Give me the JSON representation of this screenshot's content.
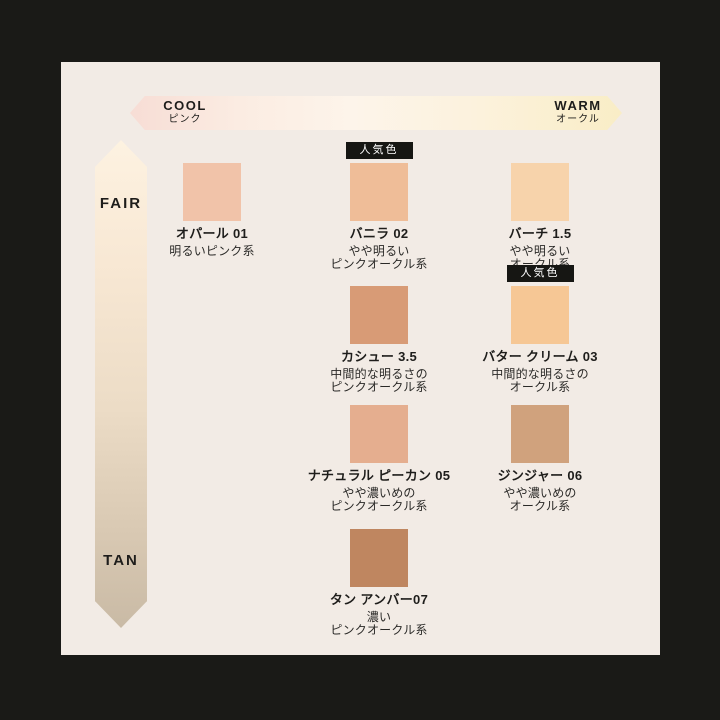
{
  "chart_title": "foundation-shade-map",
  "axes": {
    "horizontal": {
      "cool_label": "COOL",
      "cool_sub": "ピンク",
      "warm_label": "WARM",
      "warm_sub": "オークル",
      "gradient_left": "#f7ddd5",
      "gradient_right": "#f9edc6"
    },
    "vertical": {
      "top_label": "FAIR",
      "bottom_label": "TAN",
      "gradient_top": "#fdf2e1",
      "gradient_bottom": "#c9baa5"
    }
  },
  "badge_label": "人気色",
  "palette": {
    "frame": "#1a1a17",
    "panel_background": "#f2ebe5",
    "badge_background": "#161613",
    "badge_text": "#ffffff",
    "text": "#1e1d1b"
  },
  "shades": [
    {
      "name": "オパール 01",
      "desc1": "明るいピンク系",
      "desc2": "",
      "color": "#f1c3a9",
      "popular": false
    },
    {
      "name": "バニラ 02",
      "desc1": "やや明るい",
      "desc2": "ピンクオークル系",
      "color": "#efbd98",
      "popular": true
    },
    {
      "name": "バーチ 1.5",
      "desc1": "やや明るい",
      "desc2": "オークル系",
      "color": "#f7d3ab",
      "popular": false
    },
    {
      "name": "カシュー 3.5",
      "desc1": "中間的な明るさの",
      "desc2": "ピンクオークル系",
      "color": "#d89b76",
      "popular": false
    },
    {
      "name": "バター クリーム 03",
      "desc1": "中間的な明るさの",
      "desc2": "オークル系",
      "color": "#f6c795",
      "popular": true
    },
    {
      "name": "ナチュラル ピーカン 05",
      "desc1": "やや濃いめの",
      "desc2": "ピンクオークル系",
      "color": "#e5ae8f",
      "popular": false
    },
    {
      "name": "ジンジャー 06",
      "desc1": "やや濃いめの",
      "desc2": "オークル系",
      "color": "#d0a27d",
      "popular": false
    },
    {
      "name": "タン アンバー07",
      "desc1": "濃い",
      "desc2": "ピンクオークル系",
      "color": "#bf8660",
      "popular": false
    }
  ]
}
